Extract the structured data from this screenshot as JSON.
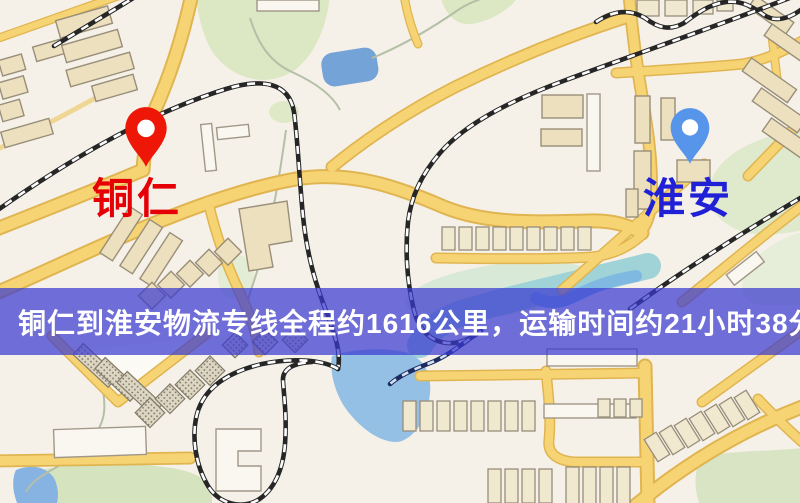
{
  "image": {
    "width": 800,
    "height": 503,
    "kind": "logistics-route-map"
  },
  "map": {
    "origin_marker": {
      "label": "铜仁",
      "pin_color": "#ed1607",
      "label_color": "#e60005"
    },
    "destination_marker": {
      "label": "淮安",
      "pin_color": "#5795eb",
      "label_color": "#2020d6"
    },
    "banner": {
      "text": "铜仁到淮安物流专线全程约1616公里，运输时间约21小时38分钟.",
      "background_color": "rgba(58,58,208,0.72)",
      "text_color": "#ffffff"
    },
    "route_summary": {
      "origin": "铜仁",
      "destination": "淮安",
      "distance_text": "约1616公里",
      "duration_text": "约21小时38分钟"
    },
    "palette": {
      "land": "#f6f1e8",
      "road_fill": "#f6d474",
      "road_casing": "#e0b551",
      "park": "#dce7c3",
      "water": "#74a3d8",
      "building": "#ece0bf",
      "railway": "#262626"
    }
  }
}
